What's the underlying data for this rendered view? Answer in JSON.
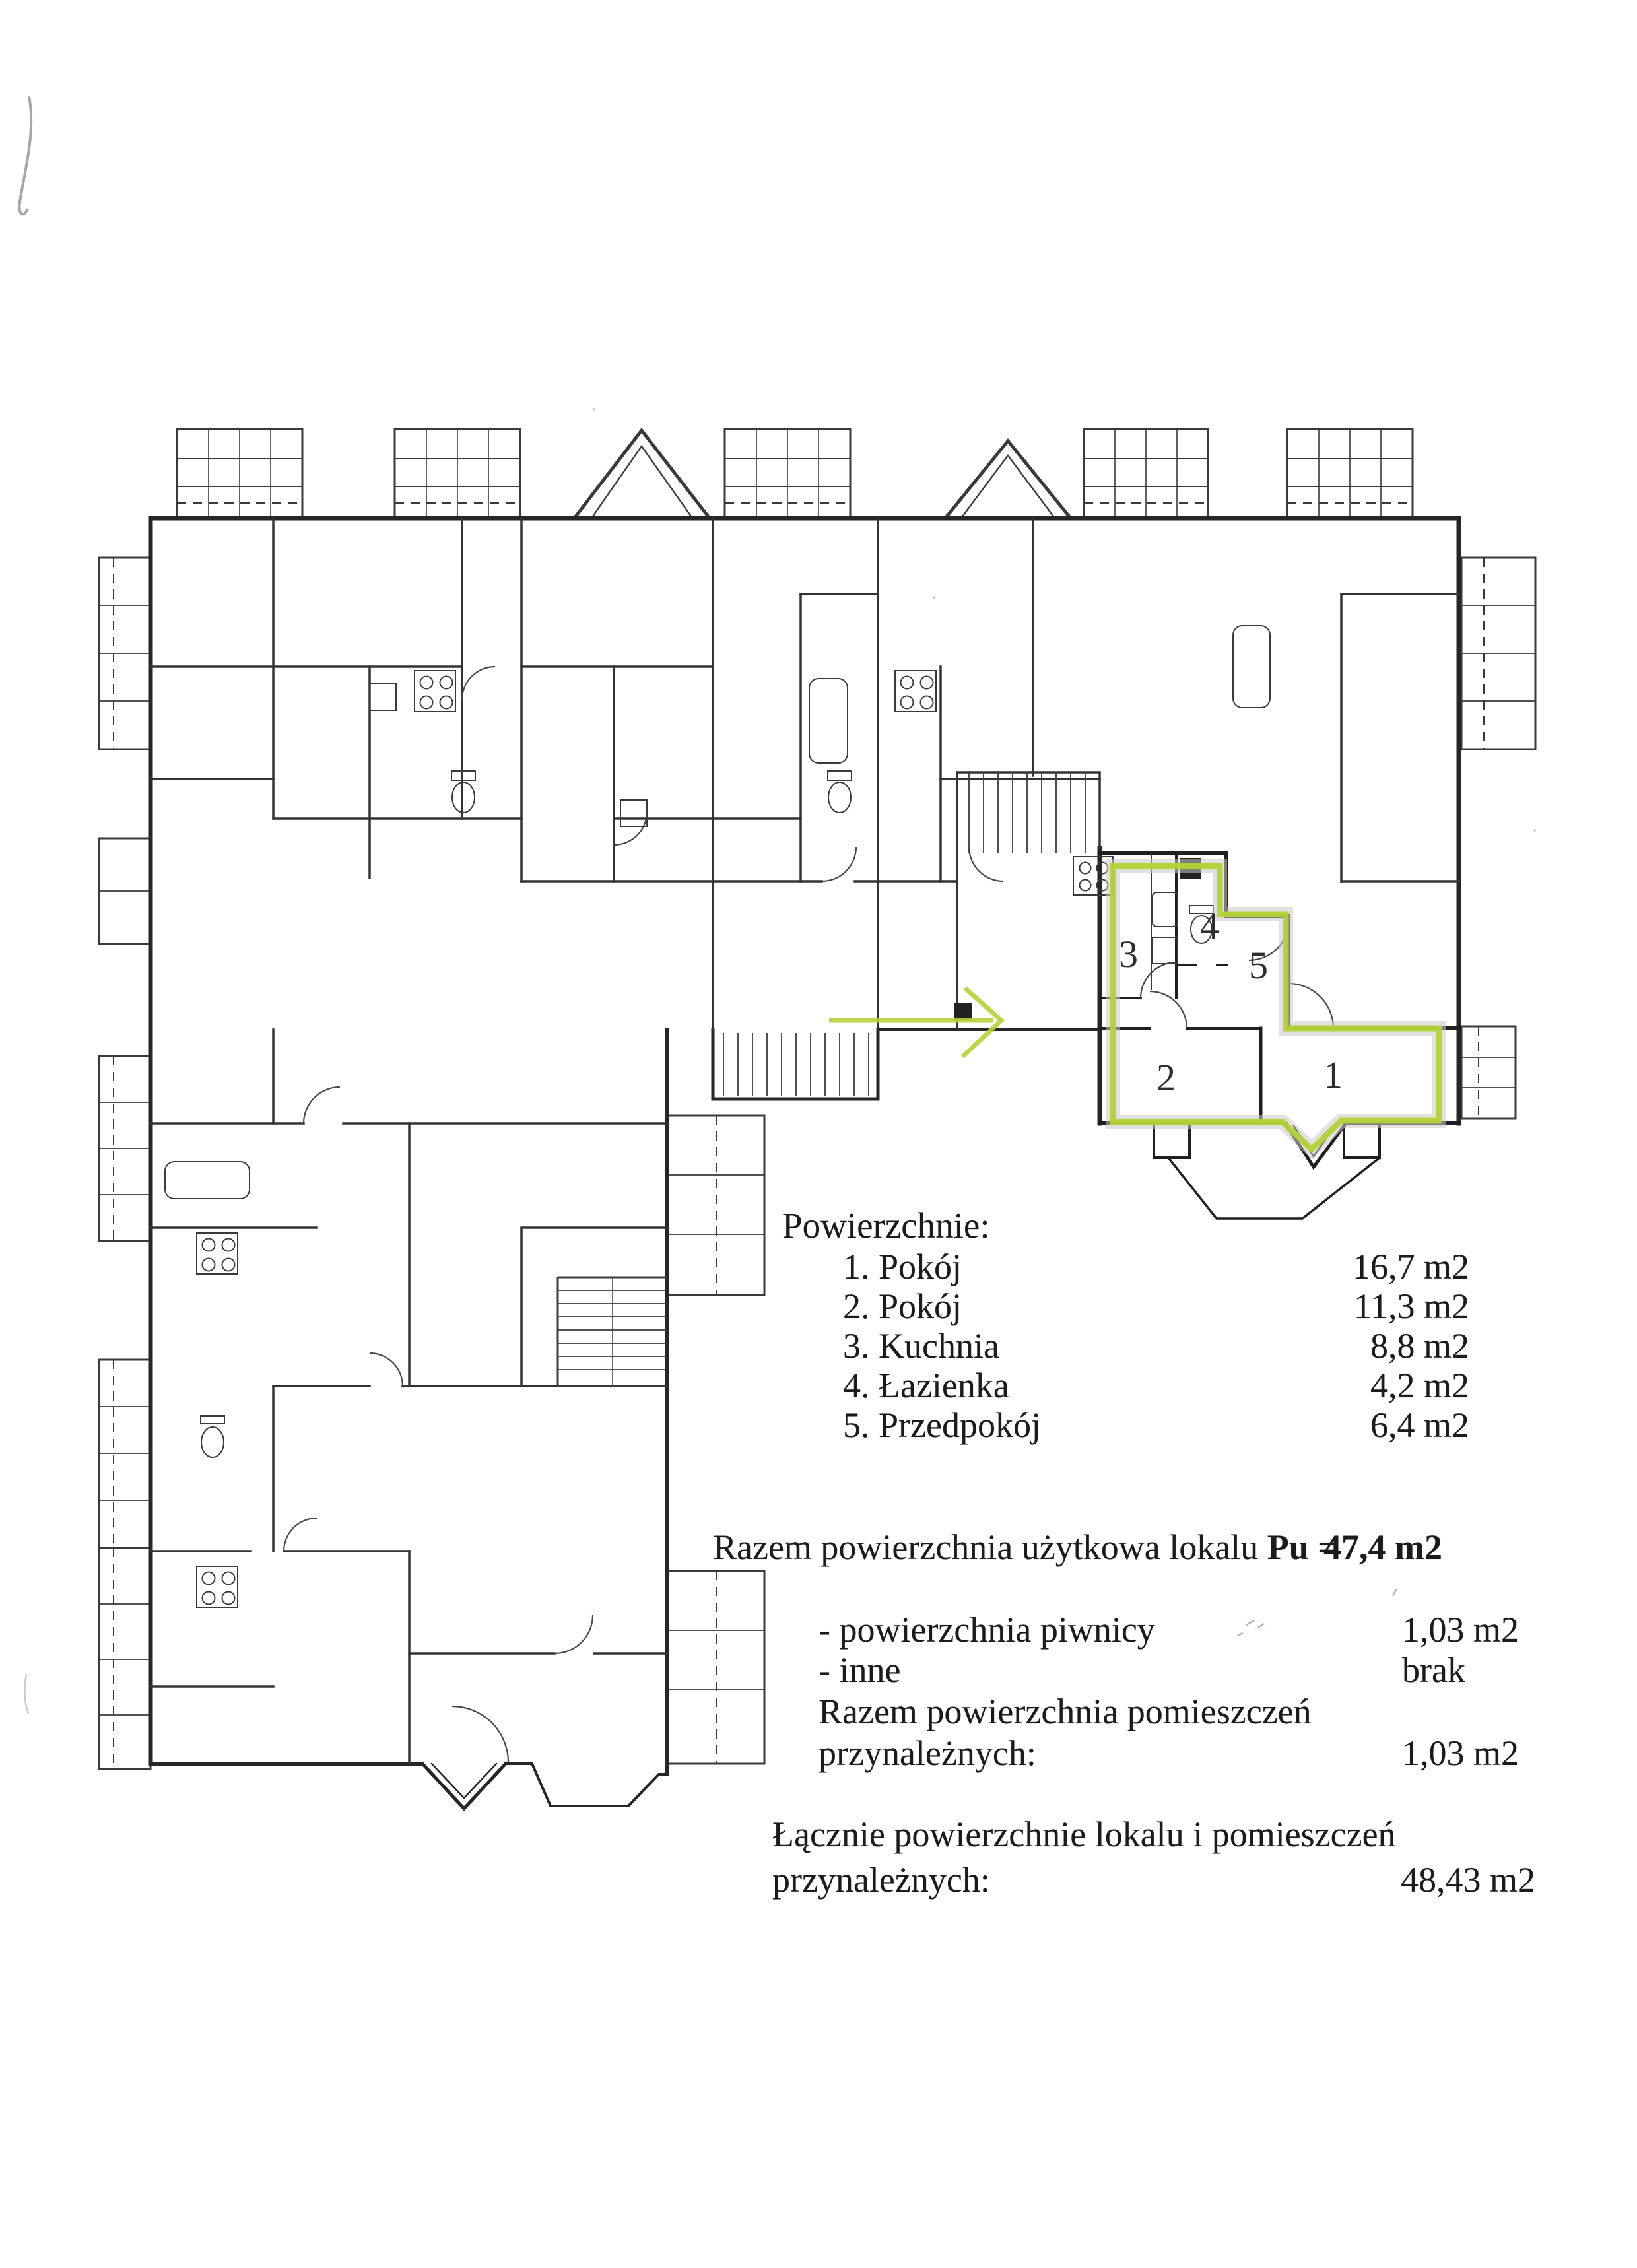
{
  "page": {
    "background": "#ffffff"
  },
  "plan": {
    "highlight_color": "#b2d235",
    "wall_color": "#2a2a2a",
    "hatch_color": "#c9c9c9",
    "room_labels": [
      "1",
      "2",
      "3",
      "4",
      "5"
    ]
  },
  "areas": {
    "title": "Powierzchnie:",
    "items": [
      {
        "label": "1. Pokój",
        "value": "16,7 m2"
      },
      {
        "label": "2. Pokój",
        "value": "11,3 m2"
      },
      {
        "label": "3. Kuchnia",
        "value": "8,8 m2"
      },
      {
        "label": "4. Łazienka",
        "value": "4,2 m2"
      },
      {
        "label": "5. Przedpokój",
        "value": "6,4 m2"
      }
    ],
    "total_label_prefix": "Razem powierzchnia użytkowa lokalu ",
    "total_label_bold": "Pu =",
    "total_value": "47,4 m2",
    "annex_items": [
      {
        "label": "- powierzchnia piwnicy",
        "value": "1,03 m2"
      },
      {
        "label": "- inne",
        "value": "brak"
      }
    ],
    "annex_total_line1": "Razem powierzchnia pomieszczeń",
    "annex_total_line2": "przynależnych:",
    "annex_total_value": "1,03 m2",
    "grand_total_line1": "Łącznie powierzchnie lokalu i pomieszczeń",
    "grand_total_line2": "przynależnych:",
    "grand_total_value": "48,43 m2"
  }
}
